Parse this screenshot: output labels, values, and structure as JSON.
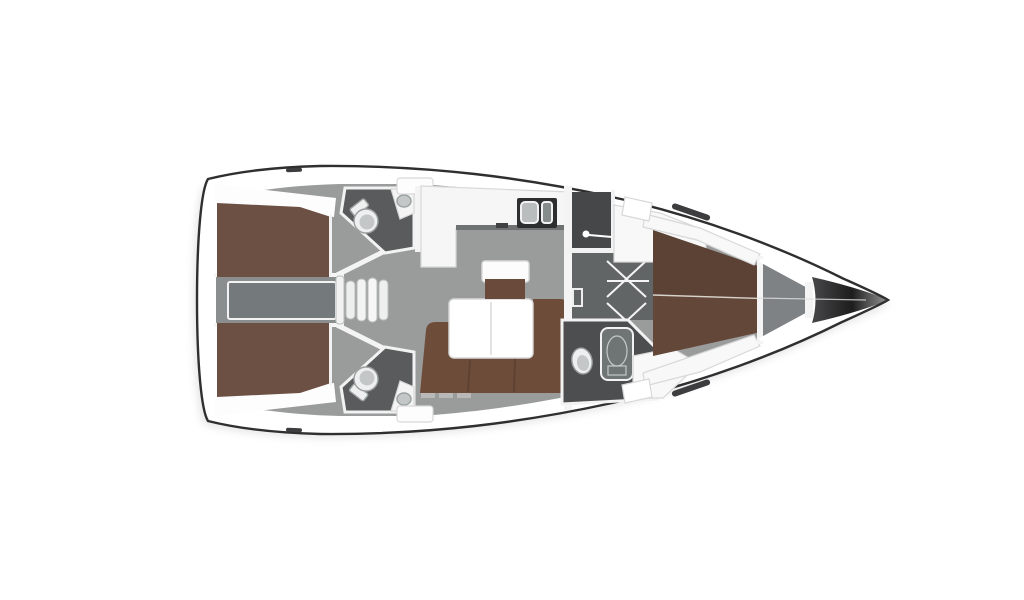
{
  "figure": {
    "subject": "sailing-yacht-interior-floor-plan",
    "view": "top-down-deck-plan",
    "bow_direction": "right",
    "background": "#ffffff",
    "cabins_visible": 3,
    "heads_visible": 3
  },
  "rooms": [
    {
      "name": "aft-cabin-port",
      "feature": "double-berth"
    },
    {
      "name": "aft-cabin-starboard",
      "feature": "double-berth"
    },
    {
      "name": "engine-compartment",
      "feature": "between-aft-cabins"
    },
    {
      "name": "aft-head-port",
      "feature": "toilet-and-sink"
    },
    {
      "name": "aft-head-starboard",
      "feature": "toilet-and-sink"
    },
    {
      "name": "companionway",
      "feature": "four-steps"
    },
    {
      "name": "galley",
      "feature": "l-counter-double-sink"
    },
    {
      "name": "salon",
      "feature": "l-sofa-folding-table-stool"
    },
    {
      "name": "shower-room",
      "feature": "door-handle"
    },
    {
      "name": "wardrobe",
      "feature": "hanging-lockers"
    },
    {
      "name": "forward-head",
      "feature": "toilet-and-shower-tray"
    },
    {
      "name": "forward-cabin",
      "feature": "v-berth"
    },
    {
      "name": "anchor-locker",
      "feature": "bow-compartment"
    }
  ],
  "icons": [
    "toilet-icon",
    "toilet-icon",
    "toilet-icon",
    "sink-icon",
    "sink-icon",
    "sink-icon",
    "double-sink-icon",
    "shower-tray-icon",
    "hanger-icon",
    "hanger-icon",
    "steps-icon",
    "door-handle-icon",
    "mirror-icon",
    "hull-window-icon"
  ],
  "colors": {
    "outline": "#2f2f30",
    "hull": "#ffffff",
    "floor": "#9a9b9b",
    "deck": "#fdfdfd",
    "corridor": "#8b8e8f",
    "engine": "#74797b",
    "berth_aft": "#6d5044",
    "berth_fwd": "#634839",
    "berth_shade": "#00000014",
    "sofa": "#6e4c3a",
    "seat": "#6a4a3a",
    "table": "#ffffff",
    "head": "#595b5d",
    "head_fwd": "#4c4e4f",
    "shower": "#454748",
    "wardrobe": "#626566",
    "locker": "#7e8284",
    "bow_dark": "#48484a",
    "bow_tip": "#1d1d1e",
    "fixture": "#eef0f0",
    "fixture_inner": "#c3c7c7",
    "shelf": "#f8f8f8",
    "wall": "#f4f4f4",
    "counter": "#f6f6f6",
    "counter_edge": "#6f7273",
    "sink_unit": "#2c2e30",
    "basin_a": "#b9bdbe",
    "basin_b": "#868b8c",
    "shower_tray": "#6f7475",
    "tray_oval": "#8e9394",
    "slit": "#3d3d3f",
    "seam": "#d8d2cc",
    "cushion_shadow": "#00000022",
    "locker_row": "#b9b9b9"
  }
}
